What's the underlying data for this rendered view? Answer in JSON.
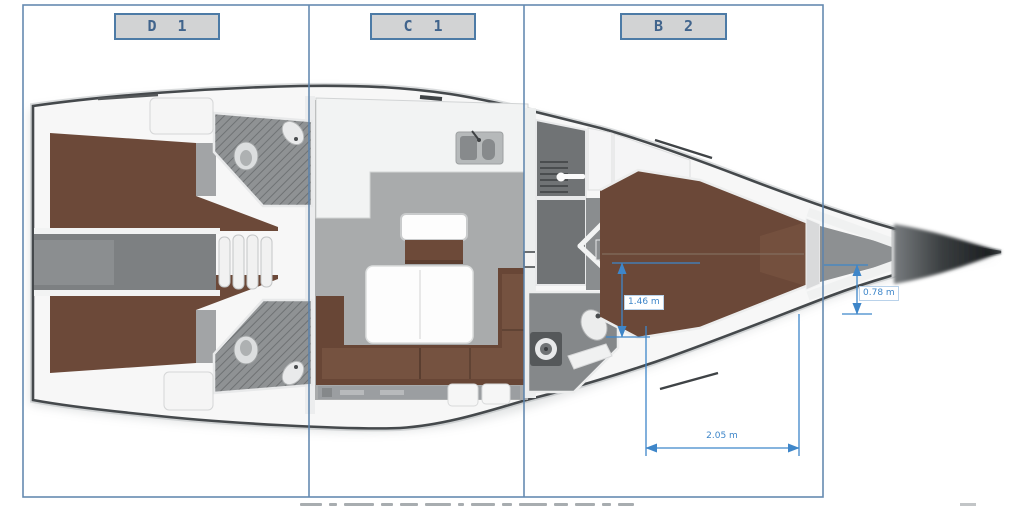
{
  "plan": {
    "zones": [
      {
        "id": "D1",
        "label": "D 1"
      },
      {
        "id": "C1",
        "label": "C 1"
      },
      {
        "id": "B2",
        "label": "B 2"
      }
    ],
    "measurements": {
      "cabin_width": "1.46 m",
      "bow_berth_width": "0.78 m",
      "berth_length": "2.05 m"
    },
    "colors": {
      "zone_line": "#5d84ad",
      "zone_box_fill": "#d2d3d4",
      "zone_box_border": "#4d7ba6",
      "zone_text": "#41648c",
      "dimension_blue": "#3e86c9",
      "hull_outline": "#45494c",
      "upholstery_brown": "#6b4839",
      "floor_gray": "#a9abac"
    }
  }
}
